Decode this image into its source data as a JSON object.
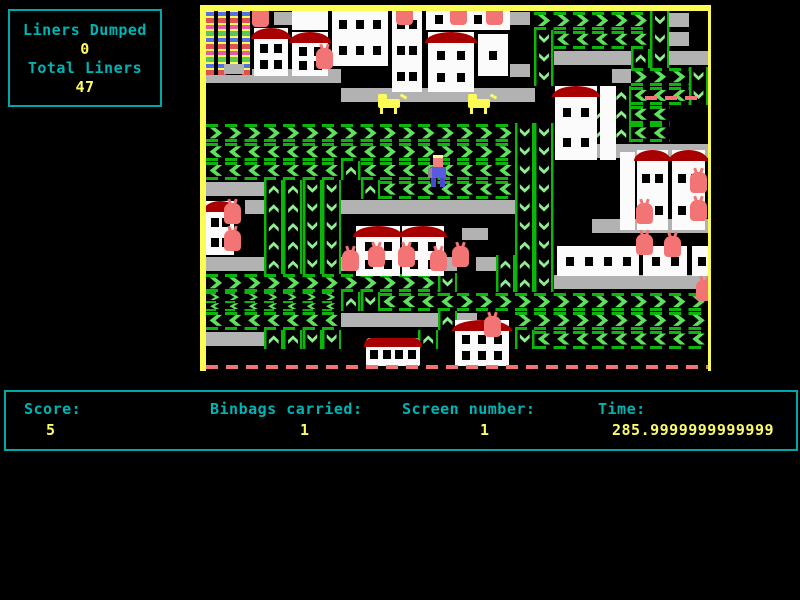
{
  "panel": {
    "liners_dumped_label": "Liners Dumped",
    "liners_dumped_value": "0",
    "total_liners_label": "Total Liners",
    "total_liners_value": "47"
  },
  "status_bar": {
    "score_label": "Score:",
    "score_value": "5",
    "binbags_label": "Binbags carried:",
    "binbags_value": "1",
    "screen_label": "Screen number:",
    "screen_value": "1",
    "time_label": "Time:",
    "time_value": "285.9999999999999"
  },
  "colors": {
    "text_cyan": "#00b4b4",
    "text_yellow": "#fcfc66",
    "border_cyan": "#00a8a8",
    "play_border_yellow": "#fcfc54",
    "conveyor_green_light": "#5ee25e",
    "conveyor_green_dark": "#0cb40c",
    "platform_gray": "#b2b2b2",
    "roof_dark_red": "#a80000",
    "binbag_red": "#f27474",
    "building_white": "#fbfbfb",
    "player_blue": "#5a5ae0",
    "dog_yellow": "#fcfc54"
  },
  "game": {
    "legend": {
      ">": "conveyor-right",
      "<": "conveyor-left",
      "^": "conveyor-up",
      "v": "conveyor-down",
      "#": "platform",
      "x": "conveyor-split",
      ".": "empty"
    },
    "grid": [
      ".................>>>>>>v#.",
      ".................v<<<<<v#.",
      ".................v####^v##",
      "#######..........v...#>>>v",
      ".......##########....^<<<v",
      "....................^^<<..",
      ">>>>>>>>>>>>>>>>vv..^^<<..",
      "<<<<<<<<<>>>>>>>vv..######",
      "<<<<<<<^<<<<<<<<vv........",
      "###^^vv.^<<<<<<<vv........",
      "..#^^vv#########vv........",
      "...^^vv.........vv..######",
      "...^^vv.........^v........",
      "###^^vv##...#.#^^v........",
      ">>>>>>>>>>>>v..^^v########",
      "xxxxxxx^v<<<<>>>>>>>>>>>>>",
      "<<<<<<<#####^#..>>>>>>>>>>",
      "###^^vv....^....v<<<<<<<<<",
      ".........................."
    ],
    "sprites": {
      "flats": [
        206,
        11,
        46,
        64
      ],
      "buildings": [
        [
          254,
          28,
          34,
          48,
          1,
          2,
          2
        ],
        [
          292,
          8,
          36,
          22,
          0,
          0,
          0
        ],
        [
          292,
          32,
          36,
          44,
          1,
          2,
          2
        ],
        [
          332,
          8,
          56,
          58,
          0,
          3,
          2
        ],
        [
          392,
          8,
          30,
          84,
          0,
          2,
          3
        ],
        [
          426,
          8,
          84,
          22,
          0,
          4,
          1
        ],
        [
          428,
          32,
          46,
          60,
          1,
          2,
          2
        ],
        [
          478,
          34,
          30,
          42,
          0,
          1,
          1
        ],
        [
          555,
          86,
          42,
          74,
          1,
          2,
          2
        ],
        [
          600,
          86,
          16,
          74,
          0,
          0,
          0
        ],
        [
          620,
          152,
          15,
          78,
          0,
          0,
          0
        ],
        [
          637,
          150,
          31,
          80,
          1,
          2,
          2
        ],
        [
          672,
          150,
          33,
          80,
          1,
          2,
          2
        ],
        [
          557,
          246,
          82,
          30,
          0,
          4,
          1
        ],
        [
          643,
          246,
          44,
          30,
          0,
          2,
          1
        ],
        [
          692,
          246,
          19,
          30,
          0,
          1,
          1
        ],
        [
          206,
          201,
          28,
          54,
          1,
          2,
          2
        ],
        [
          356,
          226,
          44,
          50,
          1,
          2,
          2
        ],
        [
          402,
          226,
          42,
          50,
          1,
          2,
          2
        ],
        [
          455,
          320,
          54,
          46,
          1,
          3,
          2
        ]
      ],
      "plats": [
        [
          274,
          12,
          18,
          13
        ],
        [
          510,
          12,
          20,
          13
        ],
        [
          510,
          64,
          20,
          13
        ],
        [
          462,
          228,
          26,
          12
        ],
        [
          224,
          64,
          20,
          10
        ]
      ],
      "bags": [
        [
          252,
          6
        ],
        [
          396,
          4
        ],
        [
          450,
          4
        ],
        [
          486,
          4
        ],
        [
          316,
          48
        ],
        [
          224,
          203
        ],
        [
          224,
          230
        ],
        [
          342,
          250
        ],
        [
          368,
          246
        ],
        [
          398,
          246
        ],
        [
          430,
          250
        ],
        [
          452,
          246
        ],
        [
          636,
          203
        ],
        [
          690,
          172
        ],
        [
          690,
          200
        ],
        [
          636,
          234
        ],
        [
          664,
          236
        ],
        [
          696,
          280
        ],
        [
          484,
          316
        ]
      ],
      "dogs": [
        [
          378,
          94
        ],
        [
          468,
          94
        ]
      ],
      "player": [
        428,
        155
      ],
      "bus": [
        366,
        338,
        54,
        28
      ],
      "dashes": [
        [
          645,
          96,
          58,
          4
        ]
      ]
    }
  }
}
